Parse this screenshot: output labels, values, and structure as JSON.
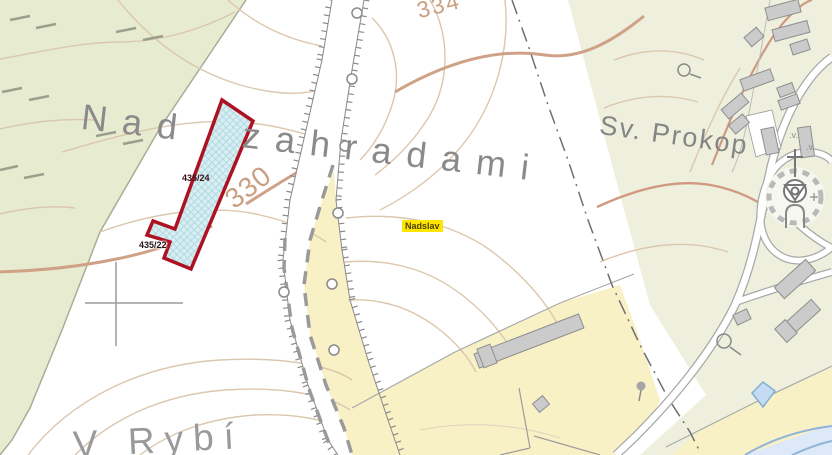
{
  "map": {
    "type": "cadastral-topographic-map",
    "place_labels": {
      "field_name": "Nad zahradami",
      "church_area": "Sv. Prokop",
      "village_highlight": "Nadslav",
      "bottom_partial": "V Rybí"
    },
    "parcel_labels": {
      "selected": "435/24",
      "neighbor": "435/22"
    },
    "contour_labels": {
      "upper": "334",
      "lower": "330"
    },
    "colors": {
      "parcel_outline": "#ae1222",
      "parcel_fill": "#d9eef2",
      "parcel_hatch": "#a6d7de",
      "highlight_bg": "#ffe600",
      "contour_thin": "#dbc7ae",
      "contour_index": "#cfa287",
      "meadow_green": "#e7ebcf",
      "settlement_green": "#eef0dd",
      "field_yellow": "#f9f1c6",
      "water_blue": "#c3dcf2",
      "road_white": "#ffffff",
      "building_gray": "#cbcbcb",
      "label_gray": "#8a8a8a"
    }
  }
}
